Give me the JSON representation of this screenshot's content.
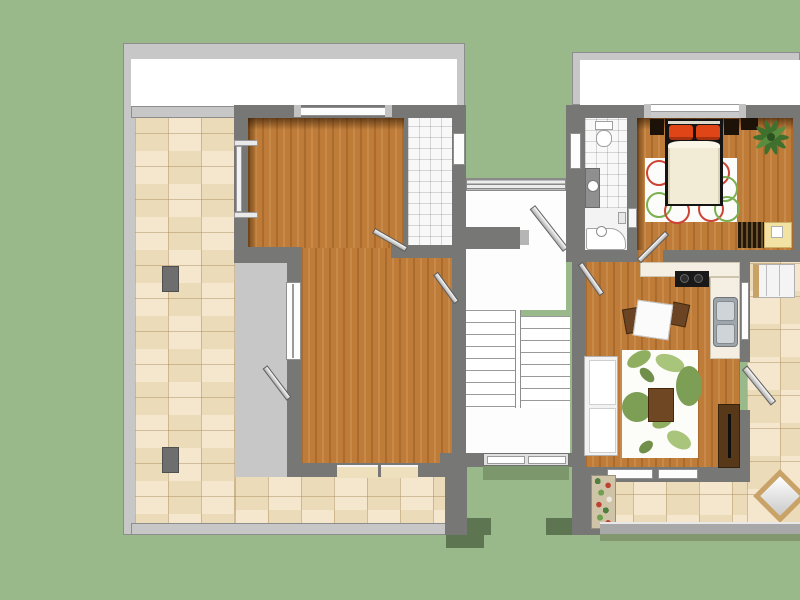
{
  "scene": {
    "title": "Top-down 3D floor plan: two apartments flanking a central stairwell",
    "background_color": "#9ab98a",
    "palette": {
      "ground_green": "#9ab98a",
      "ground_shadow": "#5d7550",
      "wall_dark": "#777776",
      "wall_light": "#c7c7c7",
      "roof_band": "#ffffff",
      "wood_floor": "#bf7c38",
      "terrace_tile": "#f0e1c3",
      "bath_tile": "#f8f8f8",
      "bed_accent_red": "#e04518",
      "rug_white": "#fcfcf8",
      "leaf_green": "#8fae5f",
      "table_wood": "#6f4823"
    },
    "stairwell": {
      "label": "Central stairwell",
      "flights": 2,
      "steps_per_flight": 8,
      "landings": 2,
      "features": [
        "bridge railing at top",
        "upper landing",
        "lower landing",
        "double entrance door",
        "open apartment door"
      ]
    },
    "left_apartment": {
      "label": "Left apartment (unfurnished)",
      "rooms": [
        {
          "name": "Top room, wood floor"
        },
        {
          "name": "Bathroom, white tiles"
        },
        {
          "name": "Main room, wood floor"
        },
        {
          "name": "L-shaped tiled terrace"
        }
      ],
      "objects": [
        {
          "name": "terrace pillar (upper)"
        },
        {
          "name": "terrace pillar (lower)"
        },
        {
          "name": "open door leaf to terrace"
        },
        {
          "name": "open door leaf between rooms"
        },
        {
          "name": "open door leaf to stairwell"
        }
      ]
    },
    "right_apartment": {
      "label": "Right apartment (furnished)",
      "rooms": [
        {
          "name": "Bathroom with toilet, washbasin, shower and tub"
        },
        {
          "name": "Bedroom"
        },
        {
          "name": "Kitchen and living room"
        },
        {
          "name": "Tiled terrace"
        }
      ],
      "furniture": [
        {
          "name": "toilet"
        },
        {
          "name": "washbasin on counter"
        },
        {
          "name": "shower / bathtub"
        },
        {
          "name": "double bed with red pillows and cream duvet"
        },
        {
          "name": "two dark nightstands"
        },
        {
          "name": "white rug with red and green circles"
        },
        {
          "name": "potted plant"
        },
        {
          "name": "slatted radiator"
        },
        {
          "name": "yellow play mat"
        },
        {
          "name": "kitchen counter with black cooktop"
        },
        {
          "name": "stainless double sink"
        },
        {
          "name": "white dining table with two wooden chairs"
        },
        {
          "name": "white two-seat sofa"
        },
        {
          "name": "white rug with green leaf pattern"
        },
        {
          "name": "dark wood coffee table"
        },
        {
          "name": "dark wood shelf cabinet"
        },
        {
          "name": "sun lounger on terrace"
        },
        {
          "name": "flower planter"
        },
        {
          "name": "square terrace table (rotated)"
        }
      ]
    }
  }
}
